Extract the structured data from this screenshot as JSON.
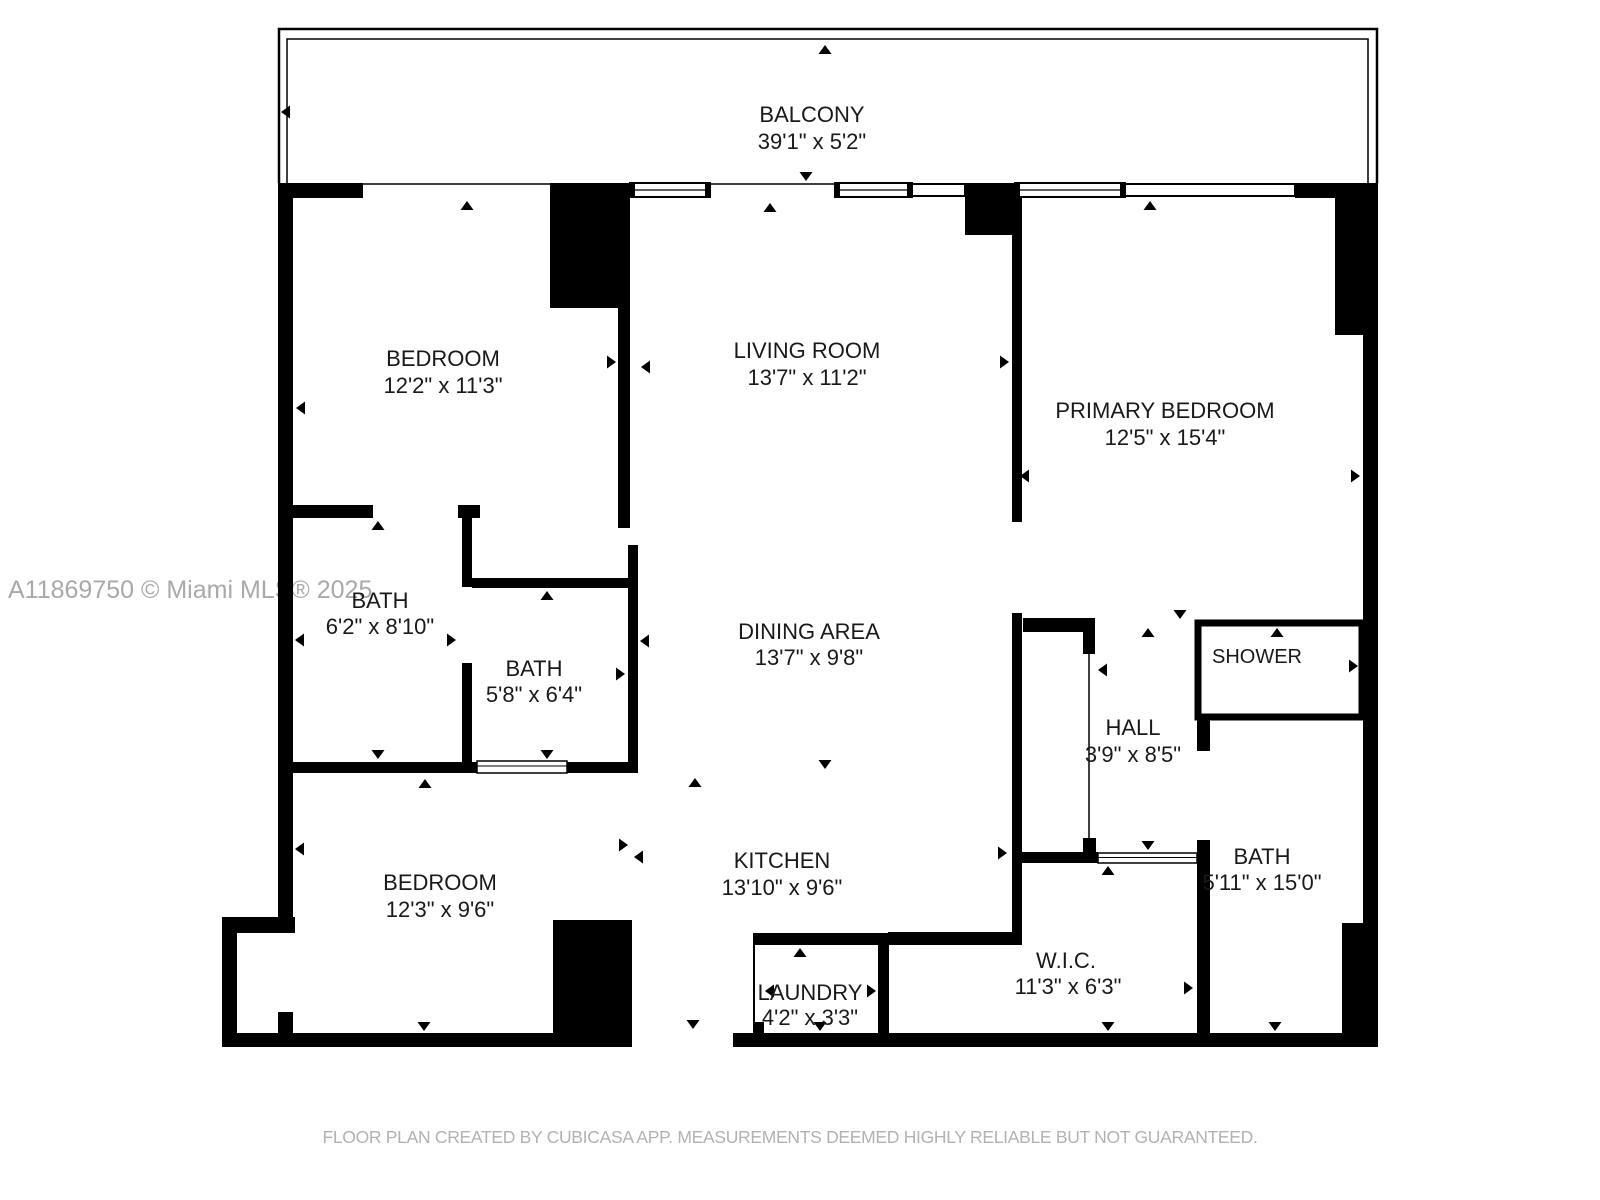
{
  "watermark": "A11869750 © Miami MLS® 2025",
  "footer": "FLOOR PLAN CREATED BY CUBICASA APP. MEASUREMENTS DEEMED HIGHLY RELIABLE BUT NOT GUARANTEED.",
  "colors": {
    "wall": "#000000",
    "background": "#ffffff",
    "watermark_text": "#a9a9a9",
    "footer_text": "#b2b2b2"
  },
  "icons": {
    "dimension_arrow": "small-black-triangle-marker"
  },
  "rooms": {
    "balcony": {
      "name": "BALCONY",
      "dims": "39'1\" x 5'2\""
    },
    "bedroom1": {
      "name": "BEDROOM",
      "dims": "12'2\" x 11'3\""
    },
    "living": {
      "name": "LIVING ROOM",
      "dims": "13'7\" x 11'2\""
    },
    "primary": {
      "name": "PRIMARY BEDROOM",
      "dims": "12'5\" x 15'4\""
    },
    "bath1": {
      "name": "BATH",
      "dims": "6'2\" x 8'10\""
    },
    "bath2": {
      "name": "BATH",
      "dims": "5'8\" x 6'4\""
    },
    "dining": {
      "name": "DINING AREA",
      "dims": "13'7\" x 9'8\""
    },
    "hall": {
      "name": "HALL",
      "dims": "3'9\" x 8'5\""
    },
    "shower": {
      "name": "SHOWER"
    },
    "bedroom2": {
      "name": "BEDROOM",
      "dims": "12'3\" x 9'6\""
    },
    "kitchen": {
      "name": "KITCHEN",
      "dims": "13'10\" x 9'6\""
    },
    "laundry": {
      "name": "LAUNDRY",
      "dims": "4'2\" x 3'3\""
    },
    "wic": {
      "name": "W.I.C.",
      "dims": "11'3\" x 6'3\""
    },
    "bath3": {
      "name": "BATH",
      "dims": "5'11\" x 15'0\""
    }
  }
}
